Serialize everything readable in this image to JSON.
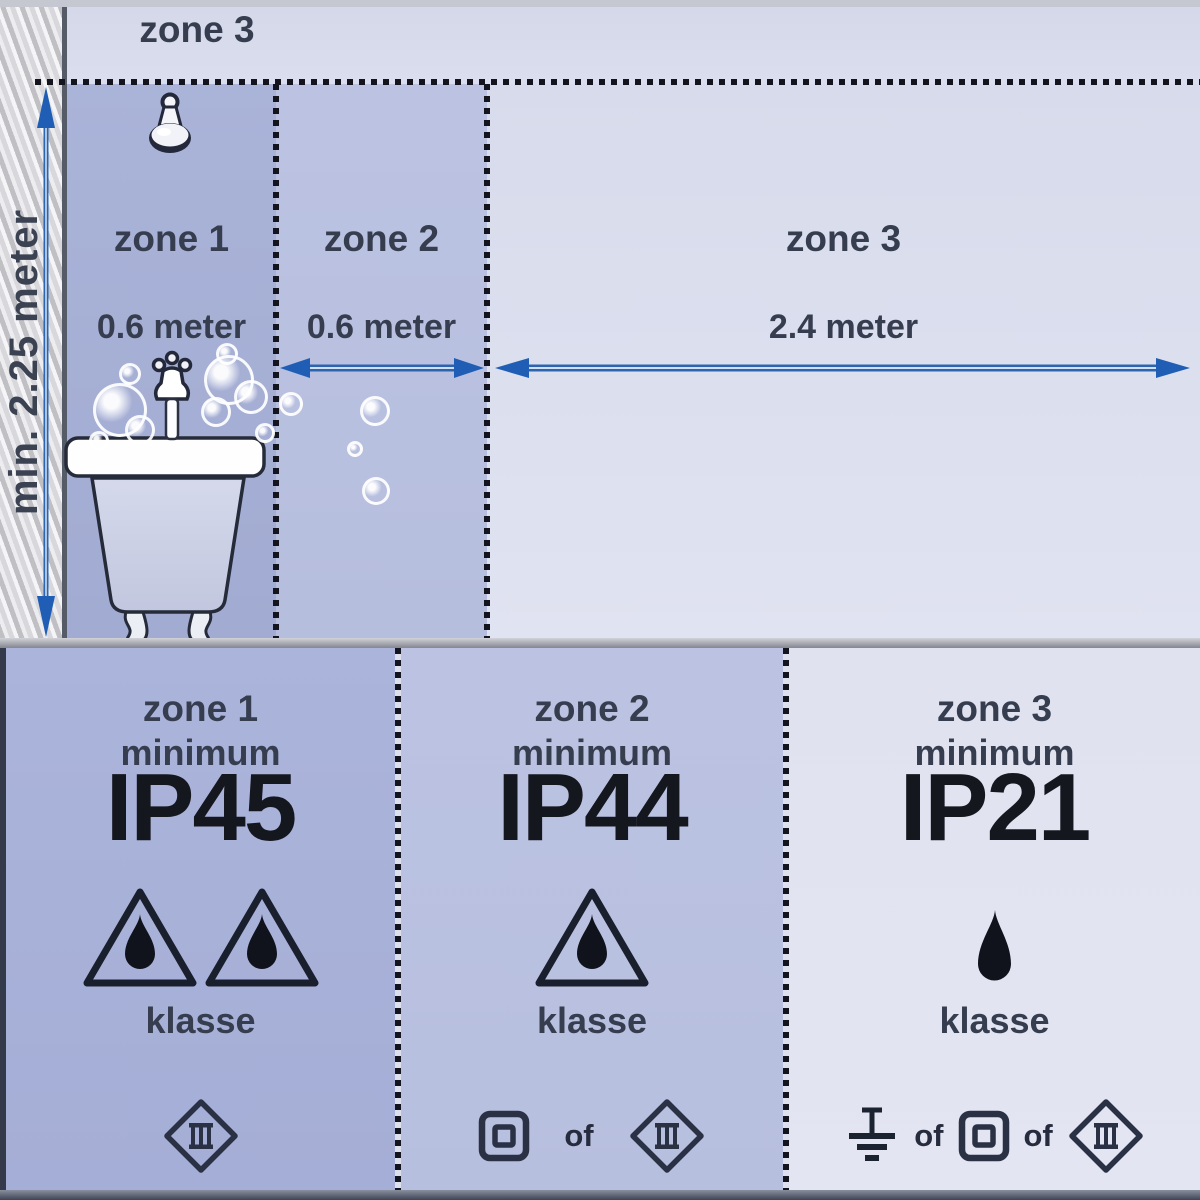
{
  "colors": {
    "accent_blue": "#2e63ae",
    "arrow_head_blue": "#1f5eb4",
    "dash_color": "#14141f",
    "zone1_bg": "#a8b1d7",
    "zone2_bg": "#bbc2e1",
    "zone3_bg": "#dde0ef",
    "panel1_bg": "#a9b2d9",
    "panel2_bg": "#bac1e1",
    "panel3_bg": "#e2e4f1",
    "label_color": "#363d4f",
    "ip_color": "#15171e"
  },
  "diagram": {
    "height_label": "min. 2.25 meter",
    "overhead_zone_label": "zone 3",
    "zone1": {
      "label": "zone 1",
      "distance": "0.6 meter"
    },
    "zone2": {
      "label": "zone 2",
      "distance": "0.6 meter"
    },
    "zone3": {
      "label": "zone 3",
      "distance": "2.4 meter"
    }
  },
  "panels": [
    {
      "zone_label": "zone 1",
      "minimum_label": "minimum",
      "ip_rating": "IP45",
      "klasse_label": "klasse"
    },
    {
      "zone_label": "zone 2",
      "minimum_label": "minimum",
      "ip_rating": "IP44",
      "klasse_label": "klasse",
      "or_label": "of"
    },
    {
      "zone_label": "zone 3",
      "minimum_label": "minimum",
      "ip_rating": "IP21",
      "klasse_label": "klasse",
      "or_label": "of",
      "or_label_2": "of"
    }
  ]
}
